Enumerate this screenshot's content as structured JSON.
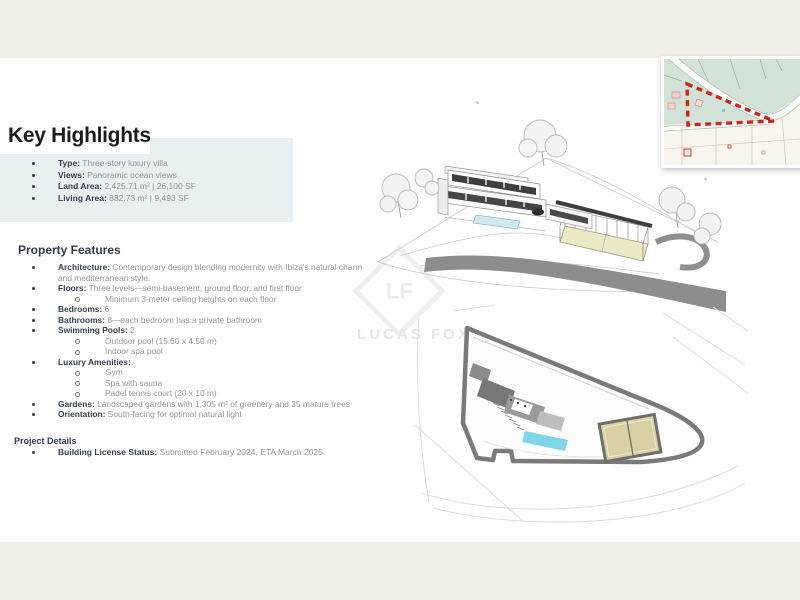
{
  "key_highlights": {
    "title": "Key Highlights",
    "items": [
      {
        "label": "Type:",
        "value": "Three-story luxury villa"
      },
      {
        "label": "Views:",
        "value": "Panoramic ocean views"
      },
      {
        "label": "Land Area:",
        "value": "2,425.71 m²   |   26,100 SF"
      },
      {
        "label": "Living Area:",
        "value": "882.73 m²   |   9,493 SF"
      }
    ]
  },
  "property_features": {
    "title": "Property Features",
    "items": [
      {
        "label": "Architecture:",
        "value": "Contemporary design blending modernity with Ibiza's natural charm and mediterranean style."
      },
      {
        "label": "Floors:",
        "value": "Three levels—semi-basement, ground floor, and first floor",
        "sub": [
          "Minimum 3-meter ceiling heights on each floor"
        ]
      },
      {
        "label": "Bedrooms:",
        "value": "6"
      },
      {
        "label": "Bathrooms:",
        "value": "8—each bedroom has a private bathroom"
      },
      {
        "label": "Swimming Pools:",
        "value": "2",
        "sub": [
          "Outdoor pool (15.60 x 4.50 m)",
          "Indoor spa pool"
        ]
      },
      {
        "label": "Luxury Amenities:",
        "value": "",
        "sub": [
          "Gym",
          "Spa with sauna",
          "Padel tennis court (20 x 10 m)"
        ]
      },
      {
        "label": "Gardens:",
        "value": "Landscaped gardens with 1,305 m² of greenery and 35 mature trees"
      },
      {
        "label": "Orientation:",
        "value": "South-facing for optimal natural light"
      }
    ]
  },
  "project_details": {
    "title": "Project Details",
    "items": [
      {
        "label": "Building License Status:",
        "value": "Submitted February 2024, ETA March 2025."
      }
    ]
  },
  "watermark": {
    "monogram": "LF",
    "text": "LUCAS FOX"
  },
  "figures": {
    "aerial_rendering": {
      "alt": "3D sketch rendering of three-story villa with pool, caged padel court, trees and road"
    },
    "site_plan": {
      "alt": "Top-down site plan of triangular walled plot with villa footprint, pool and padel court"
    },
    "location_map": {
      "alt": "Cadastral location map with plot boundary marked by red dashed line"
    }
  },
  "colors": {
    "highlight_box": "#e9f0f1",
    "margin_band": "#f2efe9",
    "heading_text": "#1c1c1a",
    "label_text": "#31404f",
    "body_text": "#8e969b",
    "plot_dash_red": "#cf2418",
    "pool_blue": "#7ed7e8",
    "court_tan": "#d8d0a2",
    "map_green": "#d3e2d7",
    "road_gray": "#8d8d8d"
  }
}
